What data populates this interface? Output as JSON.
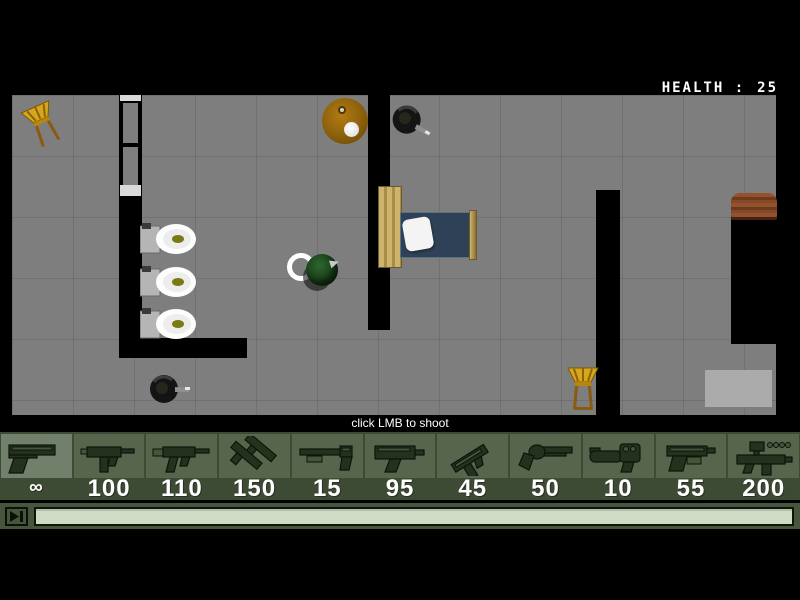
{
  "hud": {
    "health_label": "HEALTH :",
    "health_value": "25"
  },
  "hint": {
    "text": "click LMB to shoot"
  },
  "weapon_bar": {
    "selected_index": 0,
    "slots": [
      {
        "id": "desert-eagle",
        "icon": "pistol-icon",
        "ammo": "∞"
      },
      {
        "id": "uzi",
        "icon": "uzi-icon",
        "ammo": "100"
      },
      {
        "id": "mp5",
        "icon": "smg-stock-icon",
        "ammo": "110"
      },
      {
        "id": "dual-uzi",
        "icon": "dual-uzi-icon",
        "ammo": "150"
      },
      {
        "id": "shotgun",
        "icon": "shotgun-icon",
        "ammo": "15"
      },
      {
        "id": "mac10",
        "icon": "machine-pistol-icon",
        "ammo": "95"
      },
      {
        "id": "tec9",
        "icon": "tilted-pistol-icon",
        "ammo": "45"
      },
      {
        "id": "revolver",
        "icon": "revolver-icon",
        "ammo": "50"
      },
      {
        "id": "grenade-launcher",
        "icon": "grenade-launcher-icon",
        "ammo": "10"
      },
      {
        "id": "laser-pistol",
        "icon": "laser-pistol-icon",
        "ammo": "55"
      },
      {
        "id": "scoped-rifle",
        "icon": "scoped-rifle-icon",
        "ammo": "200"
      }
    ]
  },
  "colors": {
    "floor": "#7e7e7e",
    "wall": "#000000",
    "bar_background": "#3d4a34",
    "slot": "#57654c",
    "slot_selected": "#71806a",
    "ammo_text": "#ffffff",
    "health_text": "#ffffff",
    "progress_fill": "#cfdbc4",
    "chair": "#d8a61c",
    "mattress": "#2e4156",
    "table": "#8a5f0c"
  }
}
